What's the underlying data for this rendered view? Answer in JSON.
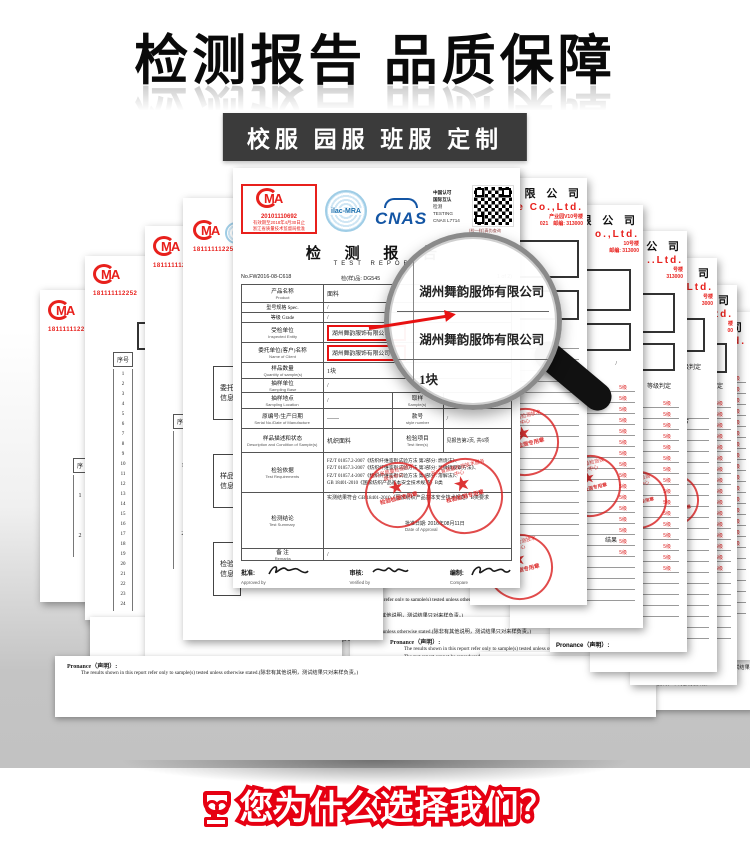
{
  "header": {
    "title": "检测报告 品质保障",
    "banner": "校服 园服 班服 定制"
  },
  "bottom": {
    "title": "您为什么选择我们？"
  },
  "shared": {
    "cma_mark": "MA",
    "cma_serial": "181111112252",
    "seq_header": "序号",
    "seq_header_short": "序",
    "seq_1_2": "1\n2",
    "seq_1_24": "1\n2\n3\n4\n5\n6\n7\n8\n9\n10\n11\n12\n13\n14\n15\n16\n17\n18\n19\n20\n21\n22\n23\n24",
    "jian_char": "检",
    "info_box_1": "委托\n信息",
    "info_box_2": "样品\n信息",
    "info_box_3": "检验\n信息",
    "grade_column": "5级\n5级\n5级\n5级\n5级\n5级\n5级\n5级\n5级\n5级\n5级\n5级\n5级\n5级\n5级\n5级",
    "grade_judge": "等级判定",
    "pass": "符合",
    "result": "结果",
    "slash": "/",
    "statement_label": "Pronance（声明）:",
    "statement_line1": "The results shown in this report refer only to sample(s) tested unless otherwise stated.(除非有其他说明，测试结果只对来样负责。)",
    "statement_line2": "The test report cannot be reproduced ,except in full.（本报告只能全部复制，不得部分复制。）"
  },
  "stamp": {
    "arc": "浙江省质量检测技术服务中心",
    "star": "★",
    "label": "检验检测专用章"
  },
  "right_pages": {
    "p1": {
      "cn": "务 有 限 公 司",
      "en": "ice Co.,Ltd.",
      "addr": "产业园V10号楼",
      "tel": "021　邮编: 313000",
      "box": "86"
    },
    "p2": {
      "cn": "限 公 司",
      "en": "o.,Ltd.",
      "addr": "10号楼",
      "tel": "邮编: 313000"
    },
    "p3": {
      "cn": "限 公 司",
      "en": "..Ltd.",
      "addr": "号楼",
      "tel": "313000"
    },
    "p4": {
      "cn": "公 司",
      "en": "Ltd.",
      "addr": "号楼",
      "tel": "3000"
    },
    "p5": {
      "cn": "公 司",
      "en": "td.",
      "addr": "楼",
      "tel": "00"
    },
    "p6": {
      "cn": "司",
      "en": "d.",
      "addr": "",
      "tel": ""
    }
  },
  "report": {
    "cma_box": {
      "code": "20101110692",
      "line1": "有效期至2018年4月30日止",
      "line2": "浙江省质量技术监督局批准"
    },
    "ilac": "ilac-MRA",
    "cnas": "CNAS",
    "accr1": "中国认可",
    "accr2": "国际互认",
    "accr3": "检测",
    "accr4": "TESTING",
    "accr5": "CNAS L7714",
    "qr_caption": "(检—样)真伪查询",
    "title": "检 测 报 告",
    "subtitle": "TEST REPORT",
    "no_left": "No.FW2016-08-C618",
    "no_mid": "检(样)品: DG545",
    "no_right": "1 of 2)",
    "rows": {
      "r1": {
        "cn": "产品名称",
        "en": "Product",
        "v": "面料"
      },
      "r2": {
        "cn": "型号规格 Spec.",
        "v": "/"
      },
      "r3": {
        "cn": "等级 Grade",
        "v": "/"
      },
      "r4": {
        "cn": "受检单位",
        "en": "Inspected Entity",
        "v": "湖州舞韵服饰有限公司"
      },
      "r5": {
        "cn": "委托单位(客户)名称",
        "en": "Name of Client",
        "v": "湖州舞韵服饰有限公司"
      },
      "r6": {
        "cn": "样品数量",
        "en": "Quantity of sample(s)",
        "v": "1块"
      },
      "r7": {
        "cn": "抽样单位",
        "en": "Sampling Base",
        "v": "/"
      },
      "r8": {
        "cn": "抽样地点",
        "en": "Sampling Location",
        "v": "/",
        "cn2": "取样",
        "en2": "Sample(s)",
        "v2": "/"
      },
      "r9": {
        "cn": "原编号/生产日期",
        "en": "Serial No./Date of Manufacture",
        "v": "------",
        "cn2": "款号",
        "en2": "style number",
        "v2": "/"
      },
      "r10": {
        "cn": "样品描述和状态",
        "en": "Description and Condition of Sample(s)",
        "v": "机织面料",
        "cn2": "检验项目",
        "en2": "Test Item(s)",
        "v2": "见报告第2页, 共6项"
      },
      "r11": {
        "cn": "检验依据",
        "en": "Test Requirements",
        "l1": "FZ/T 01057.2-2007《纺织纤维鉴别试验方法 第2部分: 燃烧法》、",
        "l2": "FZ/T 01057.3-2007《纺织纤维鉴别试验方法 第3部分: 显微镜观察方法》、",
        "l3": "FZ/T 01057.4-2007《纺织纤维鉴别试验方法 第4部分: 溶解法》、",
        "l4": "GB 18401-2010《国家纺织产品基本安全技术规范》B类"
      },
      "r12": {
        "cn": "检测结论",
        "en": "Test Summary",
        "v": "实测结果符合 GB 18401-2010《国家纺织产品基本安全技术规范》B类要求",
        "date": "批准日期: 2016年08月11日",
        "date_en": "Date of Approval"
      },
      "r13": {
        "cn": "备 注",
        "en": "Remarks",
        "v": "/"
      }
    },
    "sign": {
      "s1": "批准:",
      "s1en": "Approved by",
      "s2": "审核:",
      "s2en": "Verified by",
      "s3": "编制:",
      "s3en": "Compare"
    }
  },
  "magnifier": {
    "line1": "湖州舞韵服饰有限公司",
    "line2": "湖州舞韵服饰有限公司",
    "line3": "1块"
  }
}
